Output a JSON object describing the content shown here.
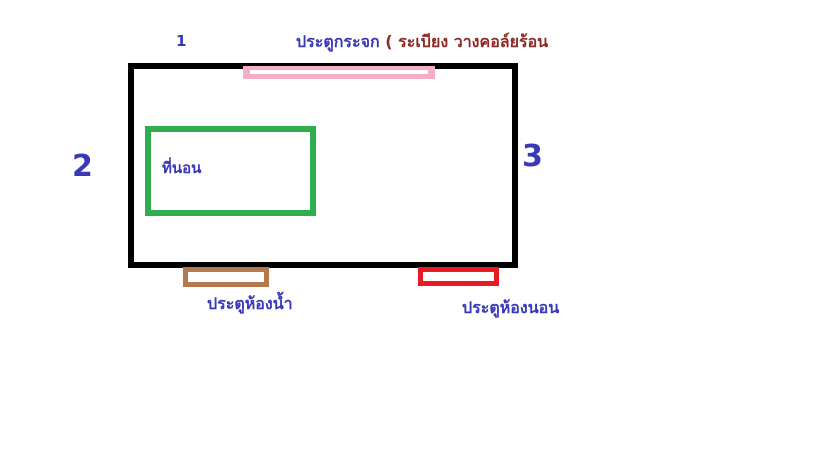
{
  "diagram": {
    "type": "floorplan-sketch",
    "markers": {
      "top": "1",
      "left": "2",
      "right": "3"
    },
    "labels": {
      "glass_door": "ประตูกระจก",
      "glass_door_note": "( ระเบียง วางคอล์ยร้อน",
      "bed": "ที่นอน",
      "bathroom_door": "ประตูห้องน้ำ",
      "bedroom_door": "ประตูห้องนอน"
    },
    "colors": {
      "background": "#ffffff",
      "wall_outline": "#000000",
      "glass_door_bar": "#f5aec7",
      "glass_door_stripe": "#ffffff",
      "bed_outline": "#2eae4d",
      "bathroom_door_outline": "#b5794e",
      "bedroom_door_outline": "#e81b23",
      "label_blue": "#3838b8",
      "note_dark_red": "#8e2a26"
    }
  }
}
